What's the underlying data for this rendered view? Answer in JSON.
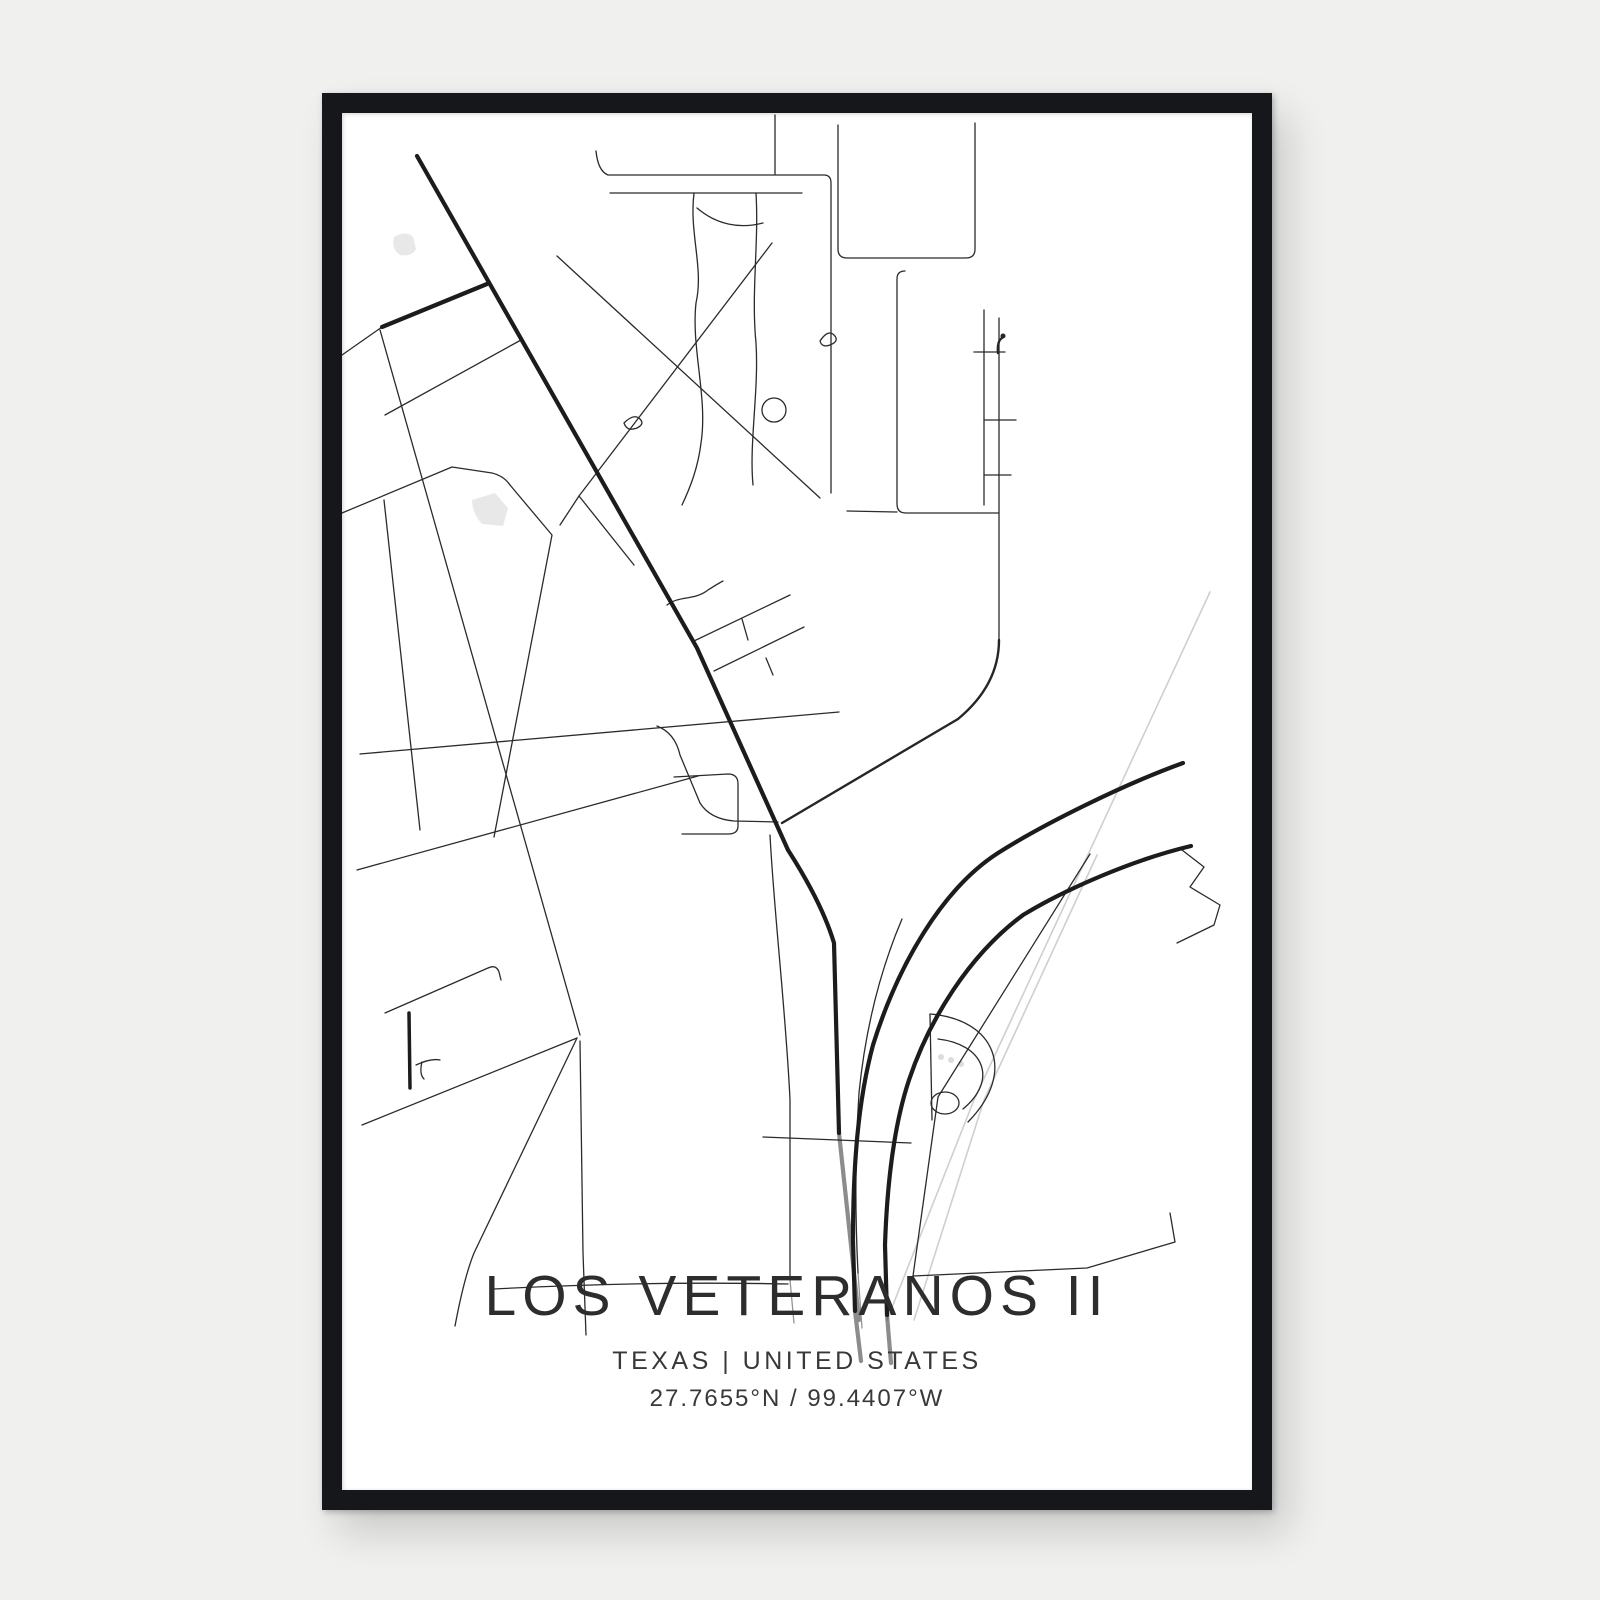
{
  "poster": {
    "title": "LOS VETERANOS II",
    "subtitle": "TEXAS | UNITED STATES",
    "coordinates": "27.7655°N / 99.4407°W"
  },
  "map": {
    "type": "minimalist-street-map-poster",
    "road_color": "#262626",
    "main_road_color": "#1c1c1c",
    "railroad_color": "#cfcfcf",
    "water_color": "#e8e8e8",
    "poster_color": "#ffffff",
    "frame_color": "#17191b",
    "background_color": "#f0f0ef",
    "text_color": "#2d2d2d"
  }
}
